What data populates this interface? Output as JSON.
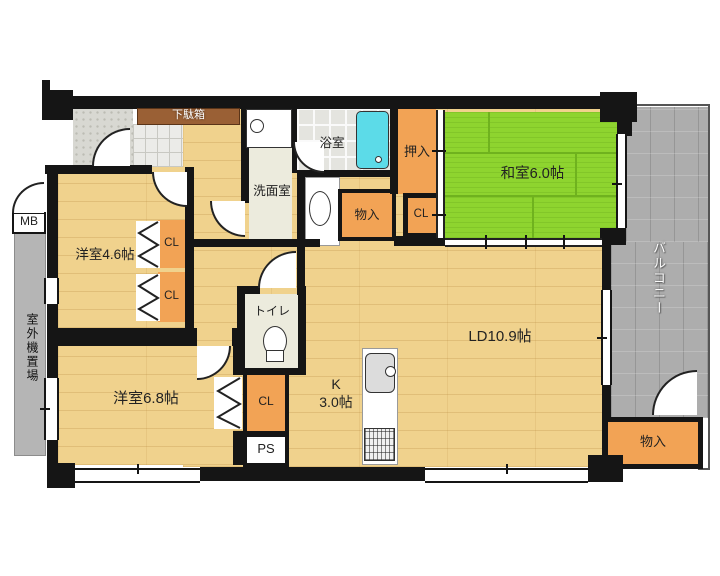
{
  "rooms": {
    "washitsu": "和室6.0帖",
    "ld": "LD10.9帖",
    "kitchen_k": "K",
    "kitchen_size": "3.0帖",
    "yoshitsu46": "洋室4.6帖",
    "yoshitsu68": "洋室6.8帖",
    "senmen": "洗面室",
    "bath": "浴室",
    "toilet": "トイレ",
    "balcony": "バルコニー",
    "outdoor_unit": "室外機置場"
  },
  "storage": {
    "getabako": "下駄箱",
    "oshiire": "押入",
    "cl_oshiire": "CL",
    "cl_46_upper": "CL",
    "cl_46_lower": "CL",
    "cl_68": "CL",
    "monoiri_center": "物入",
    "monoiri_balcony": "物入",
    "mb": "MB",
    "ps": "PS"
  },
  "colors": {
    "wall": "#151515",
    "wood": "#f0d28d",
    "tatami": "#8ed42f",
    "tatami-line": "#6fb21e",
    "closet": "#f2a355",
    "pale": "#ecebdd",
    "tile": "#e4e4df",
    "tub": "#5cdbe8",
    "balcony": "#adadad",
    "porch": "#d8d8d2",
    "genkan": "#ebebe8",
    "getabako": "#9a6035"
  }
}
